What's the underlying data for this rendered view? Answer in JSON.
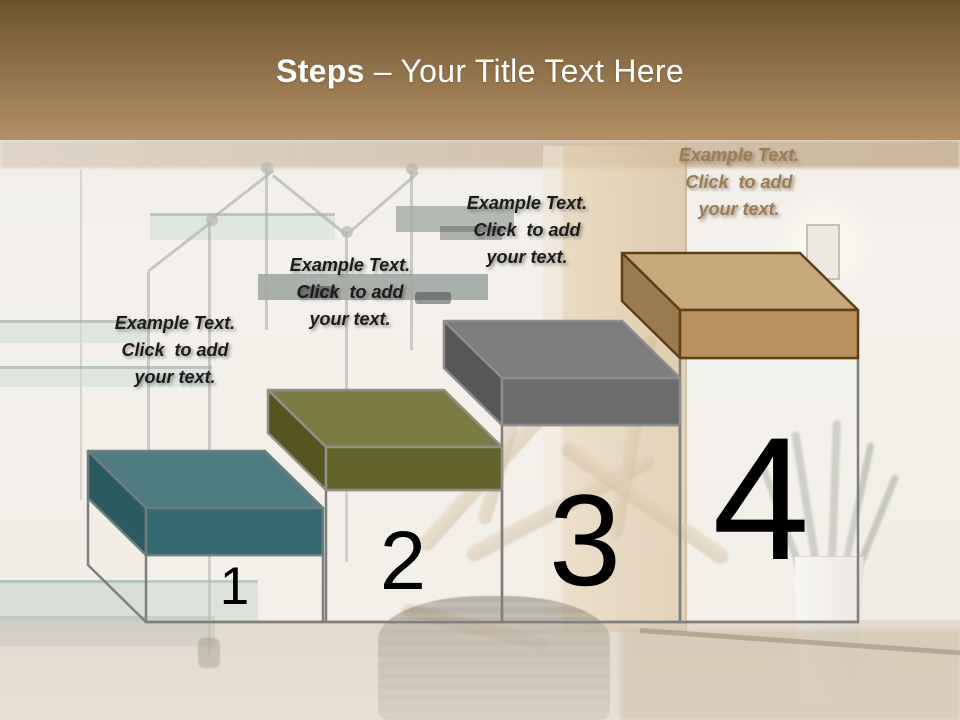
{
  "slide_title": {
    "bold": "Steps",
    "rest": "– Your Title Text Here"
  },
  "theme": {
    "header_gradient_top": "#6E5330",
    "header_gradient_bottom": "#B29067",
    "title_color": "#FFFFFF",
    "pedestal_outline": "#7F7F7F",
    "number_color": "#000000"
  },
  "steps": [
    {
      "number": "1",
      "label_lines": [
        "Example Text.",
        "Click  to add",
        "your text."
      ],
      "label_color": "#1C1C1C",
      "colors": {
        "top": "#4E7C80",
        "left": "#2B5B60",
        "front": "#356A70",
        "outline": "#6E7D7D"
      }
    },
    {
      "number": "2",
      "label_lines": [
        "Example Text.",
        "Click  to add",
        "your text."
      ],
      "label_color": "#1C1C1C",
      "colors": {
        "top": "#7A7C44",
        "left": "#565420",
        "front": "#63642B",
        "outline": "#8F8F85"
      }
    },
    {
      "number": "3",
      "label_lines": [
        "Example Text.",
        "Click  to add",
        "your text."
      ],
      "label_color": "#1C1C1C",
      "colors": {
        "top": "#7D7D7D",
        "left": "#575757",
        "front": "#6C6C6C",
        "outline": "#8C8C8C"
      }
    },
    {
      "number": "4",
      "label_lines": [
        "Example Text.",
        "Click  to add",
        "your text."
      ],
      "label_color": "#9C7C55",
      "colors": {
        "top": "#C6A87A",
        "left": "#9A7B50",
        "front": "#B8915F",
        "outline": "#5E4019"
      }
    }
  ]
}
